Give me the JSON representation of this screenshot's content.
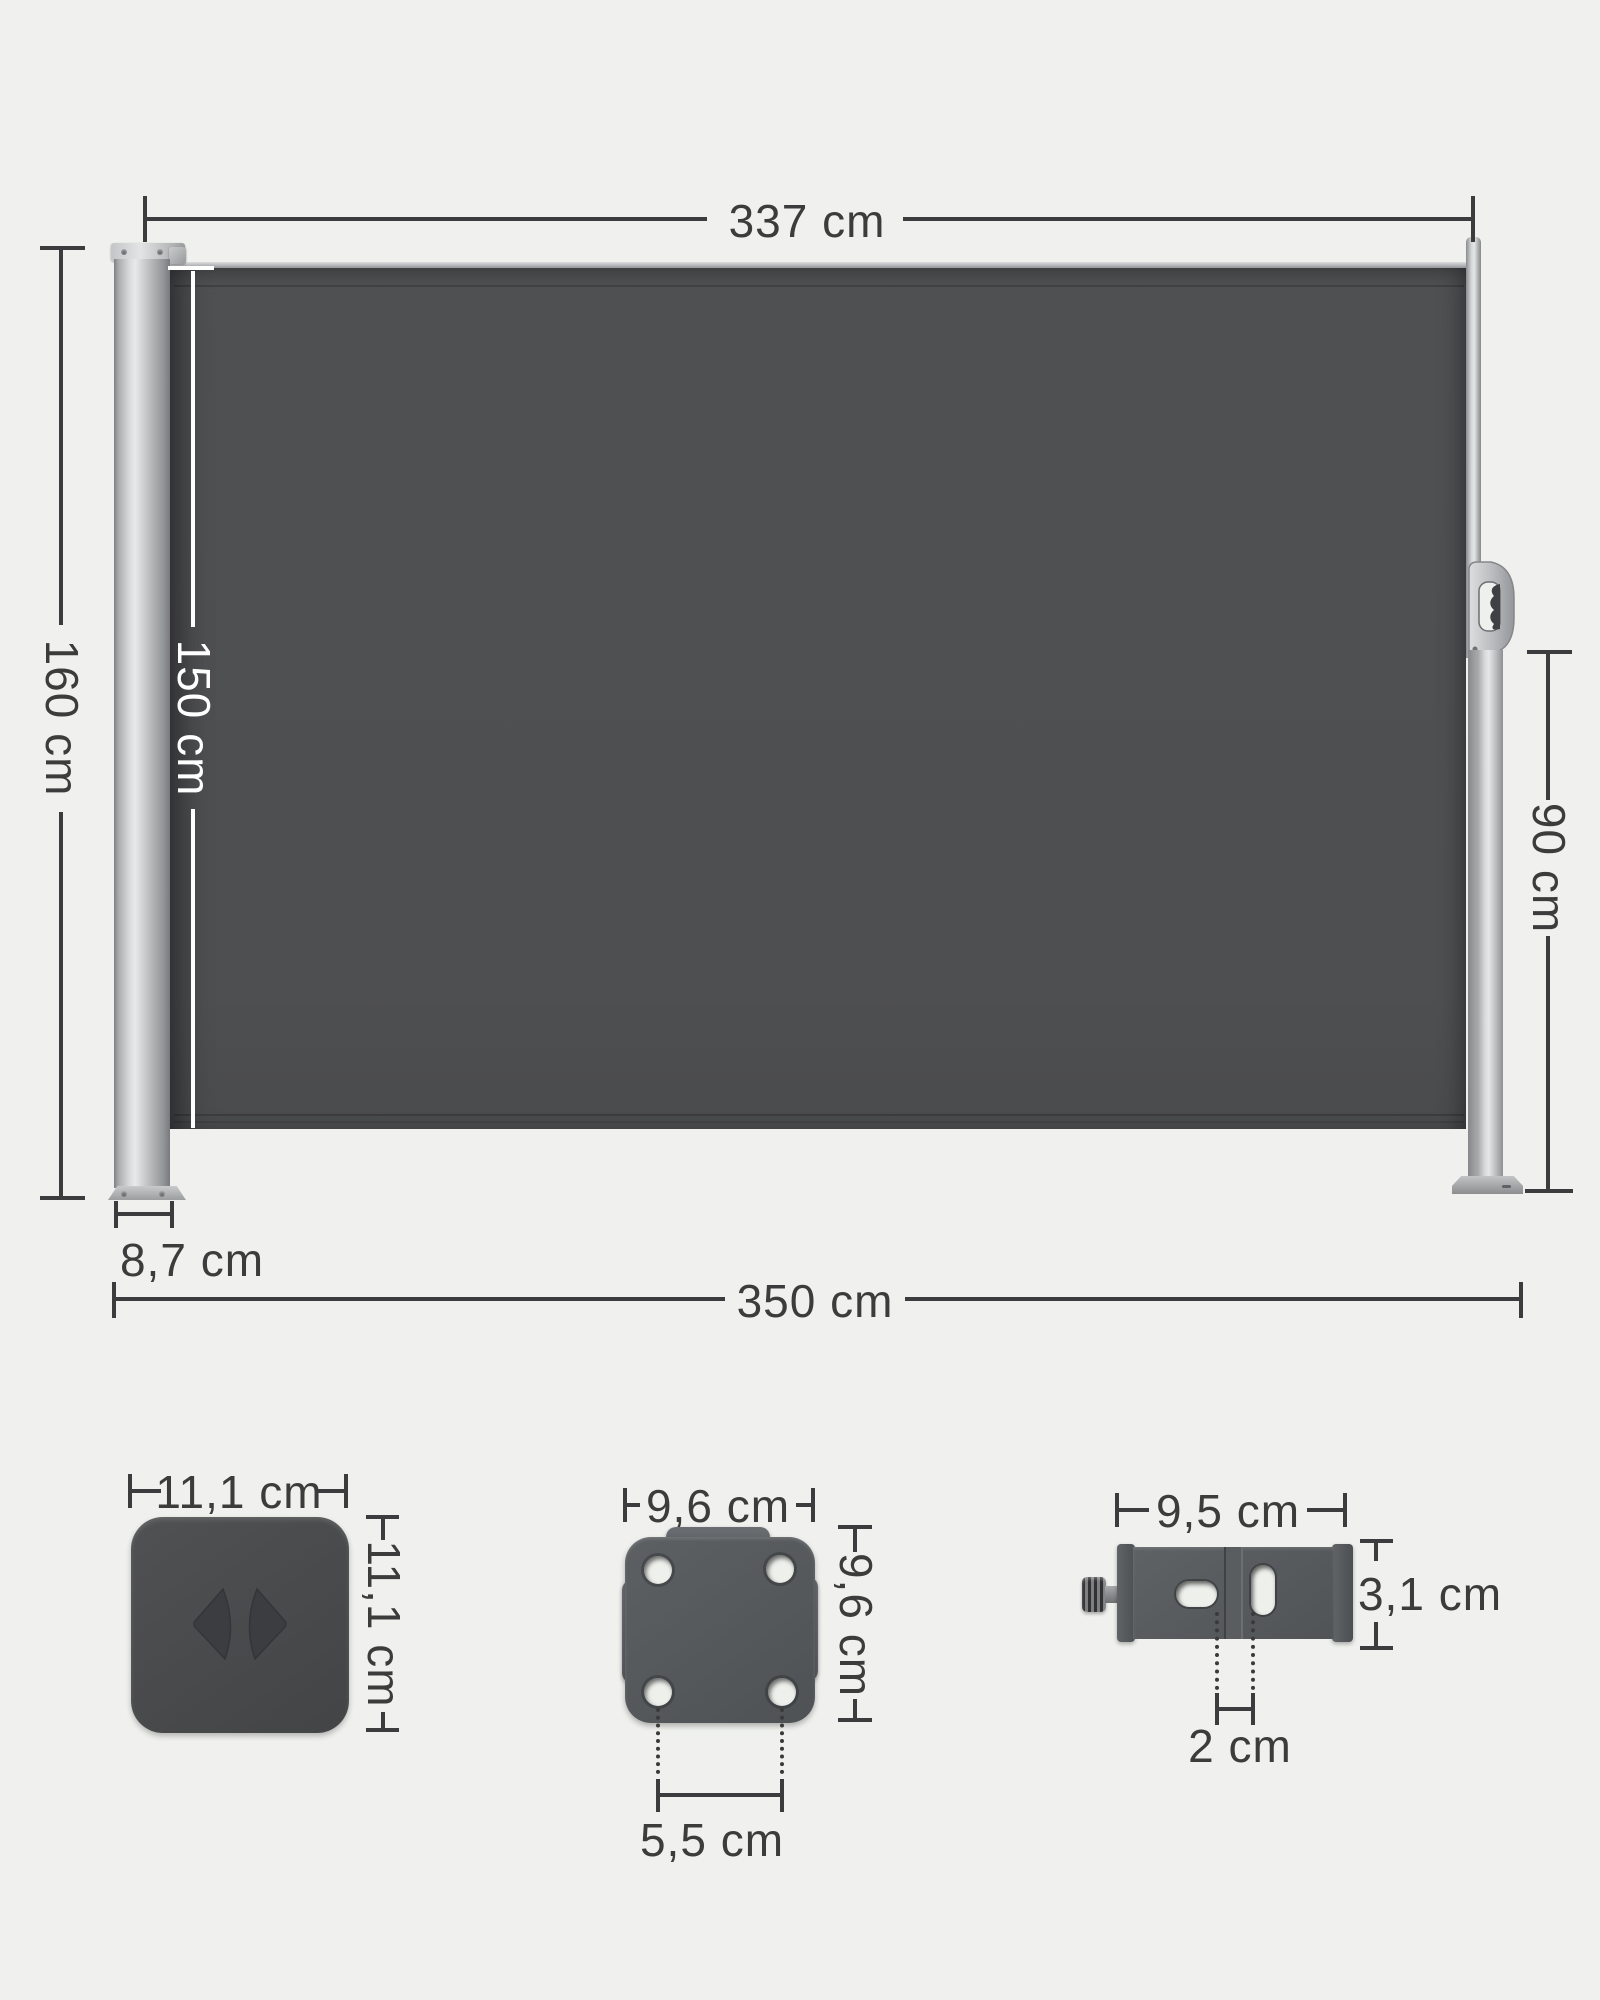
{
  "diagram_type": "product-dimension-diagram",
  "product": "retractable side awning with mounting hardware",
  "colors": {
    "background": "#f0f1ee",
    "fabric_gray": "#4e4f51",
    "frame_silver": "#c7c9cb",
    "hardware_gray": "#56595c",
    "dimension_line_dark": "#3c3c3e",
    "dimension_line_white": "#ffffff",
    "label_text": "#3c3c3c"
  },
  "main_diagram": {
    "fabric_width_label": "337 cm",
    "total_height_label": "160 cm",
    "fabric_height_label": "150 cm",
    "post_height_label": "90 cm",
    "cassette_depth_label": "8,7 cm",
    "total_width_label": "350 cm"
  },
  "components": {
    "corner_cap": {
      "width_label": "11,1 cm",
      "height_label": "11,1 cm"
    },
    "wall_plate": {
      "width_label": "9,6 cm",
      "height_label": "9,6 cm",
      "hole_spacing_label": "5,5 cm"
    },
    "floor_bracket": {
      "width_label": "9,5 cm",
      "height_label": "3,1 cm",
      "slot_spacing_label": "2 cm"
    }
  }
}
